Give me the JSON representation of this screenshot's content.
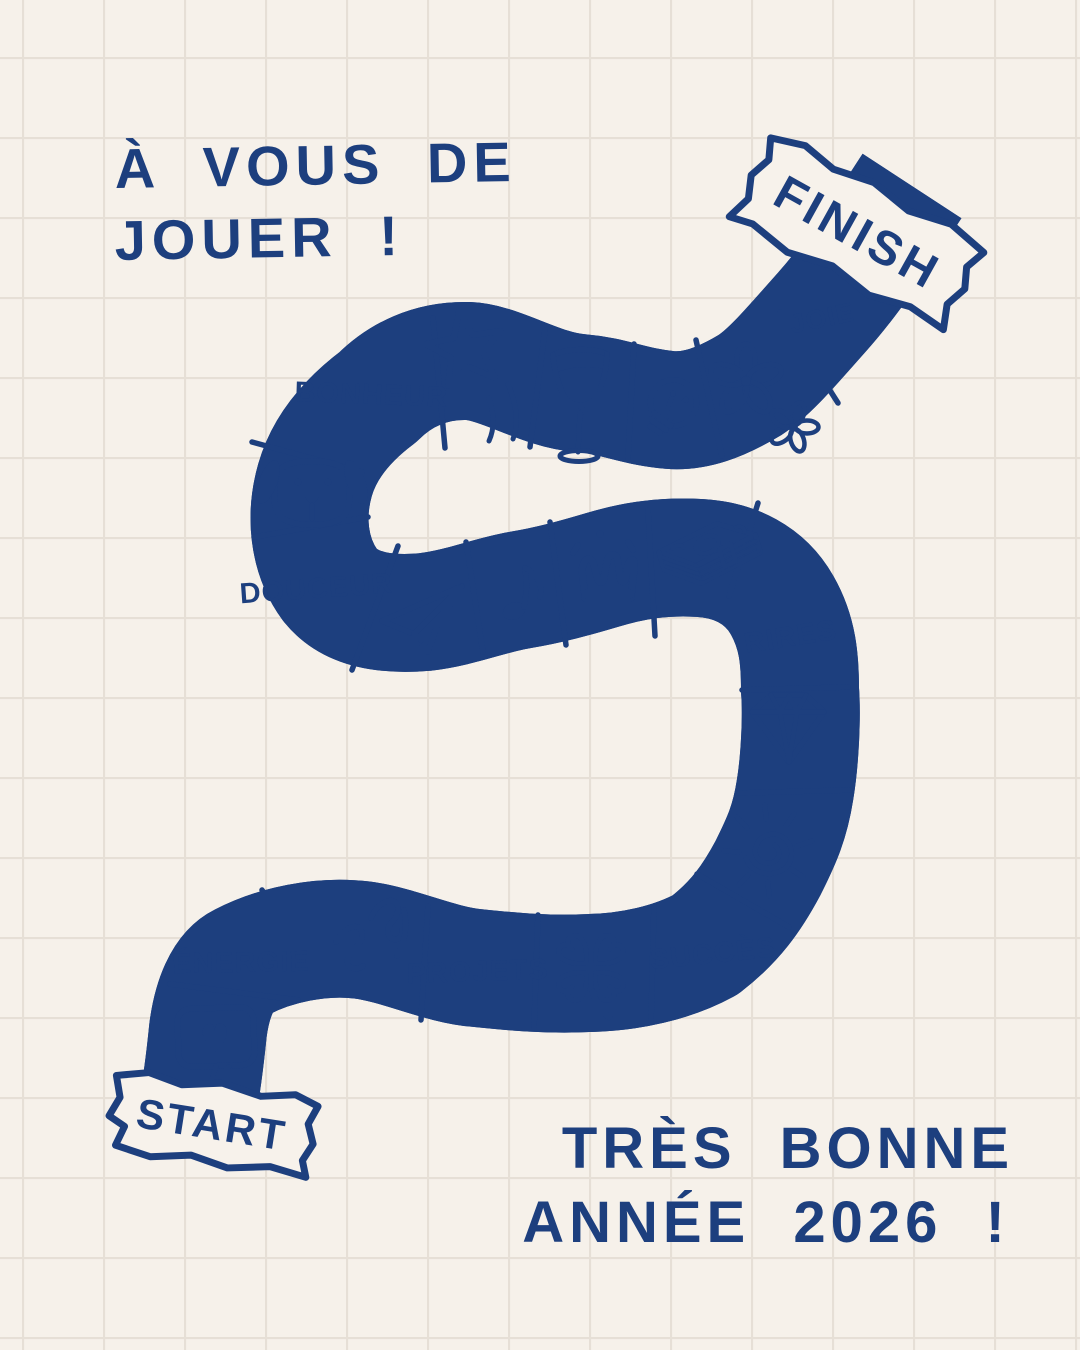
{
  "page": {
    "description": "Hand-drawn New Year greeting card styled as a board game path on graph paper",
    "colors": {
      "ink": "#1d3f7e",
      "paper": "#f6f1ea",
      "grid_line": "#e6dfd6",
      "banner_fill": "#f7f2eb"
    }
  },
  "titles": {
    "top_line1": "À VOUS DE",
    "top_line2": "JOUER !",
    "bottom_line1": "TRÈS BONNE",
    "bottom_line2": "ANNÉE 2026 !"
  },
  "banners": {
    "start": "START",
    "finish": "FINISH"
  },
  "board": {
    "cells": [
      {
        "type": "icon",
        "icon": "heart-message-icon"
      },
      {
        "type": "label",
        "label": "ÉNERGIE"
      },
      {
        "type": "icon",
        "icon": "squiggle-doodle-icon"
      },
      {
        "type": "label",
        "label": "PROJETS"
      },
      {
        "type": "icon",
        "icon": "four-leaf-clover-icon"
      },
      {
        "type": "label",
        "label": "SUCCÈS"
      },
      {
        "type": "icon",
        "icon": "sun-icon"
      },
      {
        "type": "icon",
        "icon": "diamond-icon"
      },
      {
        "type": "label",
        "label": "RIRES"
      },
      {
        "type": "icon",
        "icon": "money-stack-icon"
      },
      {
        "type": "icon",
        "icon": "crown-icon"
      },
      {
        "type": "icon",
        "icon": "music-note-icon"
      },
      {
        "type": "icon",
        "icon": "paper-plane-icon"
      },
      {
        "type": "label",
        "label": "DOUCEUR"
      },
      {
        "type": "icon",
        "icon": "dog-icon"
      },
      {
        "type": "label",
        "label": "BONHEUR"
      },
      {
        "type": "icon",
        "icon": "shooting-star-icon"
      },
      {
        "type": "icon",
        "icon": "wine-glass-icon"
      },
      {
        "type": "icon",
        "icon": "lightbulb-icon"
      },
      {
        "type": "icon",
        "icon": "flowers-icon"
      },
      {
        "type": "label",
        "label": "JOIE"
      }
    ]
  }
}
